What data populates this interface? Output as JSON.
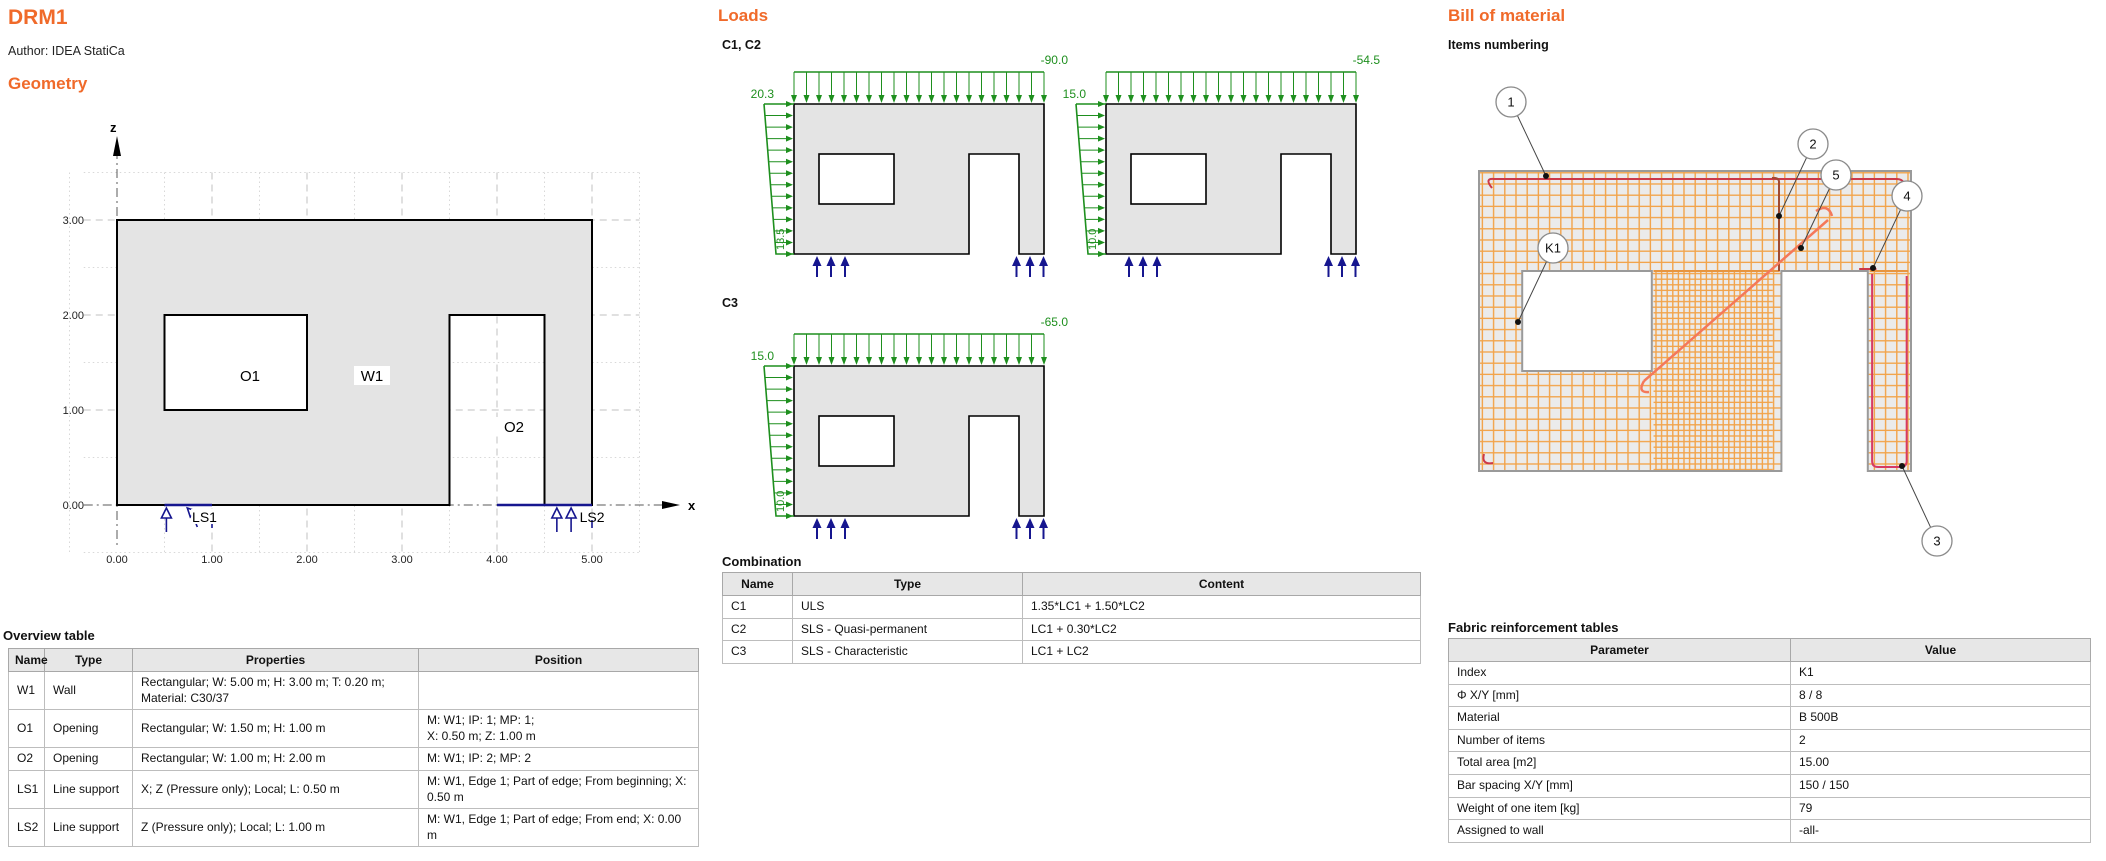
{
  "page": {
    "title": "DRM1",
    "author": "Author: IDEA StatiCa"
  },
  "colors": {
    "heading": "#f06a2a",
    "load": "#1e8f1e",
    "support": "#16168f",
    "mesh": "#f2a349",
    "mesh_edge": "#e8953f",
    "bar_red": "#cc3949",
    "bar_pink": "#d63a64",
    "bar_brown": "#a14a32",
    "bar_salmon": "#f4785a",
    "wall_fill": "#e4e4e4",
    "wall_fill_bom": "#ebebeb",
    "wall_stroke_bom": "#9a9a9a",
    "grid_minor": "#d8d8d8",
    "grid_major": "#c2c2c2",
    "axis": "#5a5a5a"
  },
  "geometry": {
    "heading": "Geometry",
    "x_axis_label": "x",
    "z_axis_label": "z",
    "x_ticks": [
      "0.00",
      "1.00",
      "2.00",
      "3.00",
      "4.00",
      "5.00"
    ],
    "z_ticks": [
      "0.00",
      "1.00",
      "2.00",
      "3.00"
    ],
    "wall_label": "W1",
    "opening1_label": "O1",
    "opening2_label": "O2",
    "support1_label": "LS1",
    "support2_label": "LS2"
  },
  "overview_table": {
    "title": "Overview table",
    "headers": [
      "Name",
      "Type",
      "Properties",
      "Position"
    ],
    "rows": [
      [
        "W1",
        "Wall",
        "Rectangular; W: 5.00 m; H: 3.00 m; T: 0.20 m;\nMaterial: C30/37",
        ""
      ],
      [
        "O1",
        "Opening",
        "Rectangular; W: 1.50 m; H: 1.00 m",
        "M: W1; IP: 1; MP: 1;\nX: 0.50 m; Z: 1.00 m"
      ],
      [
        "O2",
        "Opening",
        "Rectangular; W: 1.00 m; H: 2.00 m",
        "M: W1; IP: 2; MP: 2"
      ],
      [
        "LS1",
        "Line support",
        "X; Z (Pressure only); Local; L: 0.50 m",
        "M: W1, Edge 1; Part of edge; From beginning; X:\n0.50 m"
      ],
      [
        "LS2",
        "Line support",
        "Z (Pressure only); Local; L: 1.00 m",
        "M: W1, Edge 1; Part of edge; From end; X: 0.00\nm"
      ]
    ]
  },
  "loads": {
    "heading": "Loads",
    "group1_label": "C1, C2",
    "group2_label": "C3",
    "diagrams": [
      {
        "top": "-90.0",
        "side_top": "20.3",
        "side_bottom": "13.5"
      },
      {
        "top": "-54.5",
        "side_top": "15.0",
        "side_bottom": "10.0"
      },
      {
        "top": "-65.0",
        "side_top": "15.0",
        "side_bottom": "10.0"
      }
    ]
  },
  "combination_table": {
    "title": "Combination",
    "headers": [
      "Name",
      "Type",
      "Content"
    ],
    "rows": [
      [
        "C1",
        "ULS",
        "1.35*LC1 + 1.50*LC2"
      ],
      [
        "C2",
        "SLS - Quasi-permanent",
        "LC1 + 0.30*LC2"
      ],
      [
        "C3",
        "SLS - Characteristic",
        "LC1 + LC2"
      ]
    ]
  },
  "bom": {
    "heading": "Bill of material",
    "subtitle": "Items numbering",
    "callouts": [
      {
        "label": "1",
        "cx": 63,
        "cy": 42,
        "tx": 98,
        "ty": 116
      },
      {
        "label": "2",
        "cx": 365,
        "cy": 84,
        "tx": 331,
        "ty": 156
      },
      {
        "label": "5",
        "cx": 388,
        "cy": 115,
        "tx": 353,
        "ty": 188
      },
      {
        "label": "4",
        "cx": 459,
        "cy": 136,
        "tx": 425,
        "ty": 208
      },
      {
        "label": "K1",
        "cx": 105,
        "cy": 188,
        "tx": 70,
        "ty": 262
      },
      {
        "label": "3",
        "cx": 489,
        "cy": 481,
        "tx": 454,
        "ty": 406
      }
    ],
    "table": {
      "title": "Fabric reinforcement tables",
      "headers": [
        "Parameter",
        "Value"
      ],
      "rows": [
        [
          "Index",
          "K1"
        ],
        [
          "Φ X/Y [mm]",
          "8 / 8"
        ],
        [
          "Material",
          "B 500B"
        ],
        [
          "Number of items",
          "2"
        ],
        [
          "Total area [m2]",
          "15.00"
        ],
        [
          "Bar spacing X/Y [mm]",
          "150 / 150"
        ],
        [
          "Weight of one item [kg]",
          "79"
        ],
        [
          "Assigned to wall",
          "-all-"
        ]
      ]
    }
  }
}
